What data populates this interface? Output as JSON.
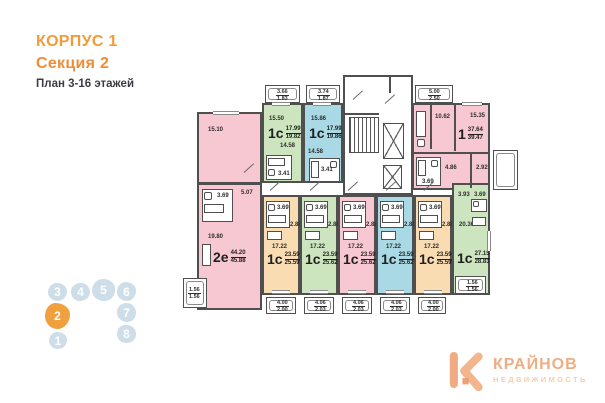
{
  "header": {
    "building": "КОРПУС 1",
    "section": "Секция 2",
    "floors": "План 3-16 этажей"
  },
  "plan": {
    "apt_2e": {
      "type": "2е",
      "area": "44.20",
      "area_total": "45.88",
      "room_top": "15.10",
      "bath": "3.69",
      "hall": "5.07",
      "room_main": "19.80",
      "balcony_a": "1.56",
      "balcony_b": "1.56"
    },
    "apt_g1": {
      "type": "1с",
      "area": "17.99",
      "area_total": "19.82",
      "room": "15.50",
      "hall": "14.58",
      "bath": "3.41",
      "balcony_a": "3.66",
      "balcony_b": "1.83"
    },
    "apt_b1": {
      "type": "1с",
      "area": "17.99",
      "area_total": "19.86",
      "room": "15.86",
      "hall": "14.58",
      "bath": "3.41",
      "balcony_a": "3.74",
      "balcony_b": "1.87"
    },
    "apt_1": {
      "type": "1",
      "area": "37.64",
      "area_total": "39.47",
      "kitchen": "10.62",
      "room": "15.35",
      "hall": "4.86",
      "bath": "3.69",
      "wardrobe": "2.92",
      "balcony_a": "5.00",
      "balcony_b": "2.50"
    },
    "row": [
      {
        "type": "1с",
        "area": "23.59",
        "area_total": "25.59",
        "room": "17.22",
        "bath": "3.69",
        "hall": "2.88",
        "balcony_a": "4.00",
        "balcony_b": "2.00"
      },
      {
        "type": "1с",
        "area": "23.59",
        "area_total": "25.62",
        "room": "17.22",
        "bath": "3.69",
        "hall": "2.88",
        "balcony_a": "4.06",
        "balcony_b": "2.03"
      },
      {
        "type": "1с",
        "area": "23.59",
        "area_total": "25.62",
        "room": "17.22",
        "bath": "3.69",
        "hall": "2.88",
        "balcony_a": "4.06",
        "balcony_b": "2.03"
      },
      {
        "type": "1с",
        "area": "23.59",
        "area_total": "25.62",
        "room": "17.22",
        "bath": "3.69",
        "hall": "2.88",
        "balcony_a": "4.06",
        "balcony_b": "2.03"
      },
      {
        "type": "1с",
        "area": "23.59",
        "area_total": "25.59",
        "room": "17.22",
        "bath": "3.69",
        "hall": "2.88",
        "balcony_a": "4.00",
        "balcony_b": "2.00"
      }
    ],
    "apt_g6": {
      "type": "1с",
      "area": "27.15",
      "area_total": "28.83",
      "room": "20.36",
      "bath": "3.93",
      "hall": "3.69",
      "balcony_a": "1.56",
      "balcony_b": "1.56"
    }
  },
  "section_map": {
    "top": [
      "3",
      "4",
      "5",
      "6"
    ],
    "left": [
      "2",
      "1"
    ],
    "right": [
      "7",
      "8"
    ]
  },
  "logo": {
    "title": "КРАЙНОВ",
    "subtitle": "НЕДВИЖИМОСТЬ"
  },
  "colors": {
    "pink": "#F8C8D2",
    "green": "#CDE5BE",
    "blue": "#AAD9E6",
    "orange": "#FADCB2",
    "wall": "#4F4F50",
    "accent": "#F0A13E"
  }
}
